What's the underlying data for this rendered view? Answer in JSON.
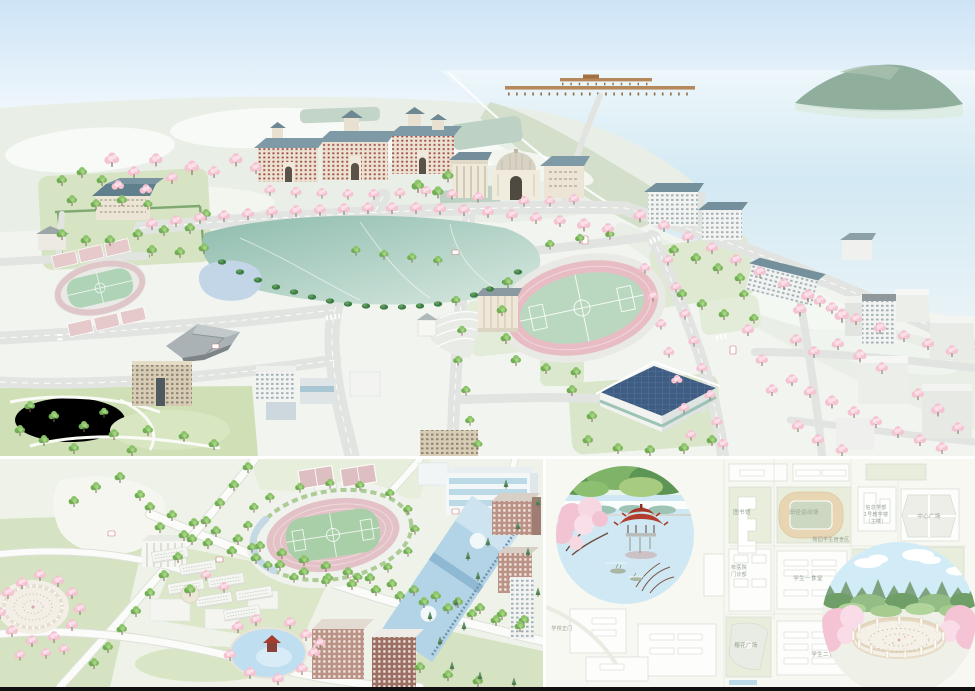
{
  "document": {
    "title": "Cherry Blossom Campus Illustrated Map",
    "panels": [
      "campus-aerial-map",
      "south-campus-aerial-map",
      "campus-plan-minimap"
    ]
  },
  "palette": {
    "sky": "#cfe5f6",
    "sea": "#d3e9f3",
    "hill": "#e9efe7",
    "hill_light": "#f7faf6",
    "ground": "#f2f4f0",
    "road": "#e2e4e1",
    "lake_dark": "#8ebcad",
    "lake_light": "#d7e8e0",
    "pond_blue": "#c2d6e8",
    "grass": "#d6e4c4",
    "park": "#cfe0b6",
    "track_pink": "#e7bdc3",
    "field_green": "#b9d8bf",
    "cherry": "#f5c3d2",
    "cherry_light": "#fbdfe9",
    "tree_green": "#7fb95e",
    "roof_slate": "#7e9aa6",
    "cream": "#ece3d2",
    "brick_red": "#a24a44",
    "gym_roof": "#3f5d82",
    "museum_gray": "#aab2b5",
    "bl_blue": "#b3d4e6",
    "bl_brick": "#bb9286",
    "bl_brick_dark": "#9b6f63",
    "map_block_green": "#e8eedb",
    "stadium_tan": "#e7d5b3",
    "stadium_infield": "#ccd8c2",
    "pavilion_red": "#b23c2e",
    "inset_water": "#cfe8f3",
    "inset_sky": "#d2ecf7",
    "pergola_cream": "#e8dcc6",
    "label_gray": "#98a396",
    "island_green": "#8fae9c",
    "pier_wood": "#b5895c",
    "bar_black": "#101010"
  },
  "aerial_map": {
    "features": [
      "lake-water",
      "island-hill",
      "wooden-pier",
      "old-dormitory-row",
      "old-library-dome",
      "campus-lake",
      "athletics-stadium",
      "practice-field",
      "art-museum",
      "gymnasium",
      "classical-hall",
      "cherry-avenues",
      "city-blocks",
      "west-park"
    ]
  },
  "south_map": {
    "features": [
      "stadium",
      "tennis-courts",
      "natatorium",
      "dormitory-rows",
      "round-pergola-garden",
      "pavilion-pond",
      "brick-teaching-buildings",
      "white-gravel-field"
    ]
  },
  "minimap": {
    "labels": {
      "library": "图书馆",
      "athletic_field": "田径运动场",
      "clinic_l1": "校医院",
      "clinic_l2": "门诊部",
      "sakura_plaza": "樱花广场",
      "canteen1": "学生一食堂",
      "canteen2": "学生二食堂",
      "dept_l1": "信息学部",
      "dept_l2": "1号教学楼",
      "dept_l3": "（主楼）",
      "center_plaza": "中心广场",
      "main_gate": "学校正门",
      "dorm_area": "樱园学生宿舍区"
    },
    "insets": [
      "lakeside-pavilion",
      "cherry-pergola-garden"
    ]
  }
}
